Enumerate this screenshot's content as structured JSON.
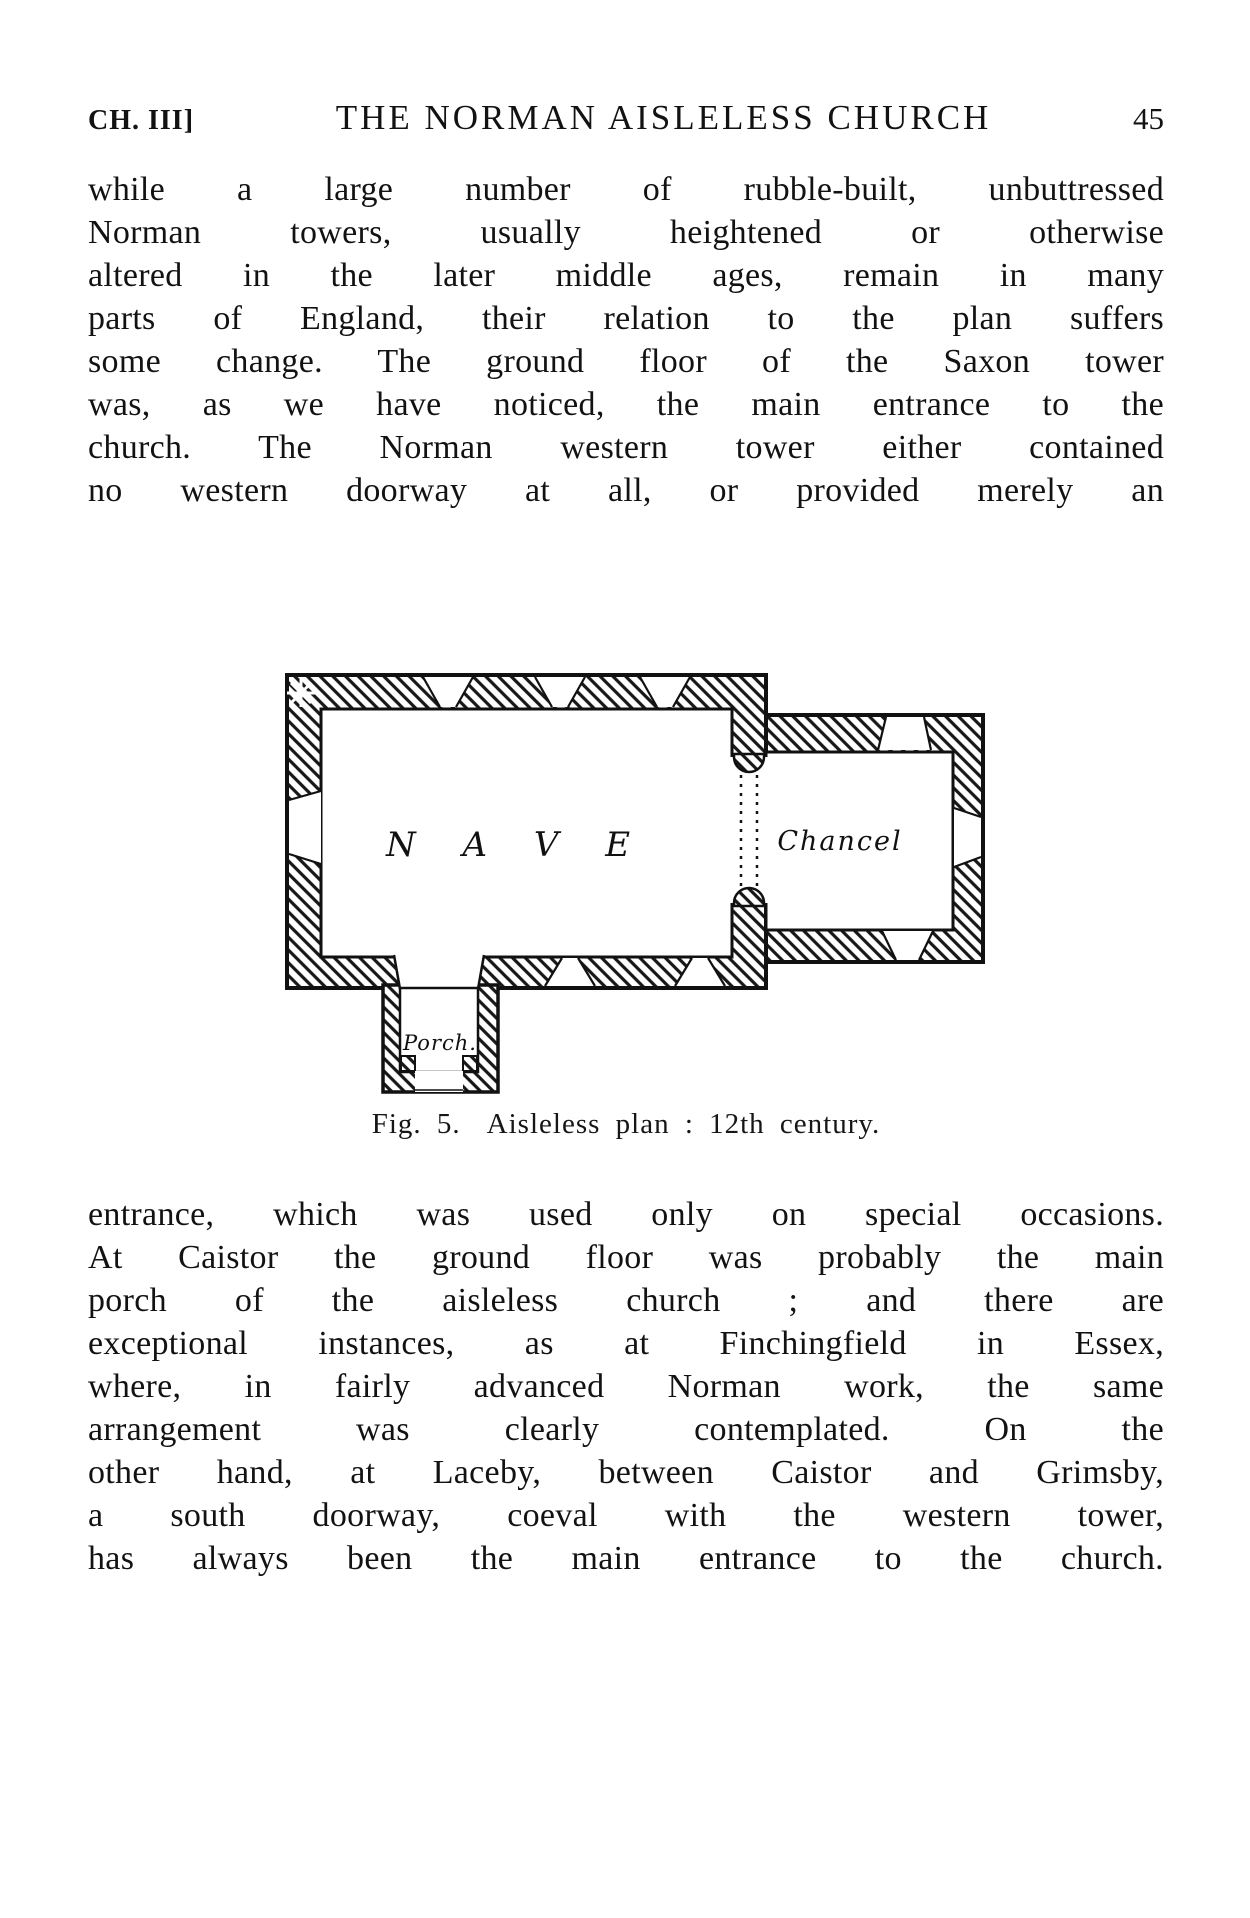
{
  "header": {
    "chapter": "CH. III]",
    "title": "THE NORMAN AISLELESS CHURCH",
    "page_number": "45"
  },
  "para1": {
    "lines": [
      "while a large number of rubble-built, unbuttressed",
      "Norman towers, usually heightened or otherwise",
      "altered in the later middle ages, remain in many",
      "parts of England, their relation to the plan suffers",
      "some change.  The ground floor of the Saxon tower",
      "was, as we have noticed, the main entrance to the",
      "church.  The Norman western tower either contained",
      "no western doorway at all, or provided merely an"
    ]
  },
  "figure": {
    "labels": {
      "nave": "N A V E",
      "chancel": "Chancel",
      "porch": "Porch."
    }
  },
  "caption": {
    "fig": "Fig. 5.",
    "text": "Aisleless plan : 12th century."
  },
  "para2": {
    "lines": [
      "entrance, which was used only on special occasions.",
      "At Caistor the ground floor was probably the main",
      "porch of the aisleless church ; and there are",
      "exceptional instances, as at Finchingfield in Essex,",
      "where, in fairly advanced Norman work, the same",
      "arrangement was clearly contemplated.  On the",
      "other hand, at Laceby, between Caistor and Grimsby,",
      "a south doorway, coeval with the western tower,",
      "has always been the main entrance to the church."
    ]
  }
}
